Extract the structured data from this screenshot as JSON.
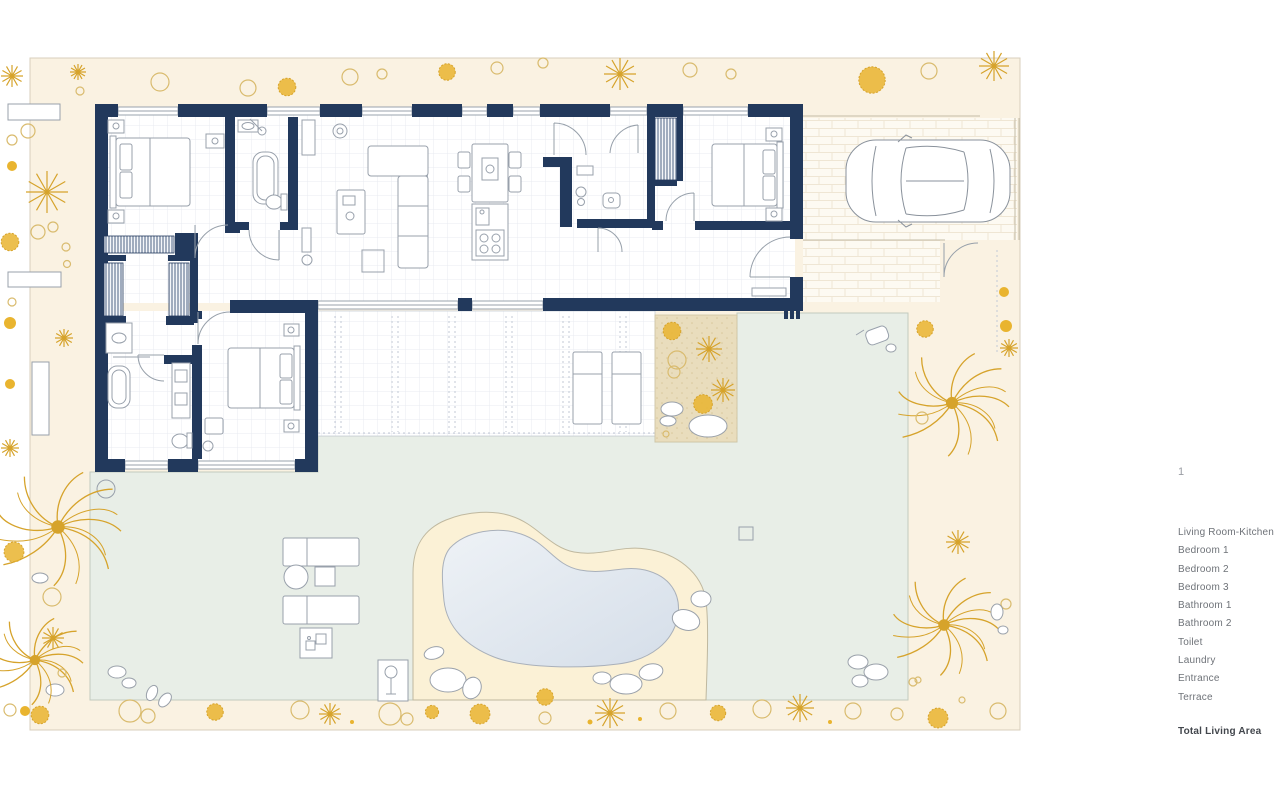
{
  "title": "Villa floor plan with garden, pool and carport",
  "legend": {
    "marker": "1",
    "items": [
      "Living Room-Kitchen",
      "Bedroom 1",
      "Bedroom  2",
      "Bedroom  3",
      "Bathroom 1",
      "Bathroom 2",
      "Toilet",
      "Laundry",
      "Entrance",
      "Terrace"
    ],
    "total_label": "Total Living Area"
  },
  "colors": {
    "wall_navy": "#22395c",
    "site_cream": "#faf2e2",
    "lawn_green": "#e8eee7",
    "pool_water": "#dbe3ed",
    "pool_deck": "#fbf1d6",
    "sand": "#e8dcba",
    "plant_gold": "#d6a32b",
    "plant_gold_fill": "#e9b42f",
    "plant_ring": "#d9bb6e",
    "furniture_line": "#98a0ab",
    "legend_text": "#6e7278",
    "legend_total": "#43474d"
  }
}
